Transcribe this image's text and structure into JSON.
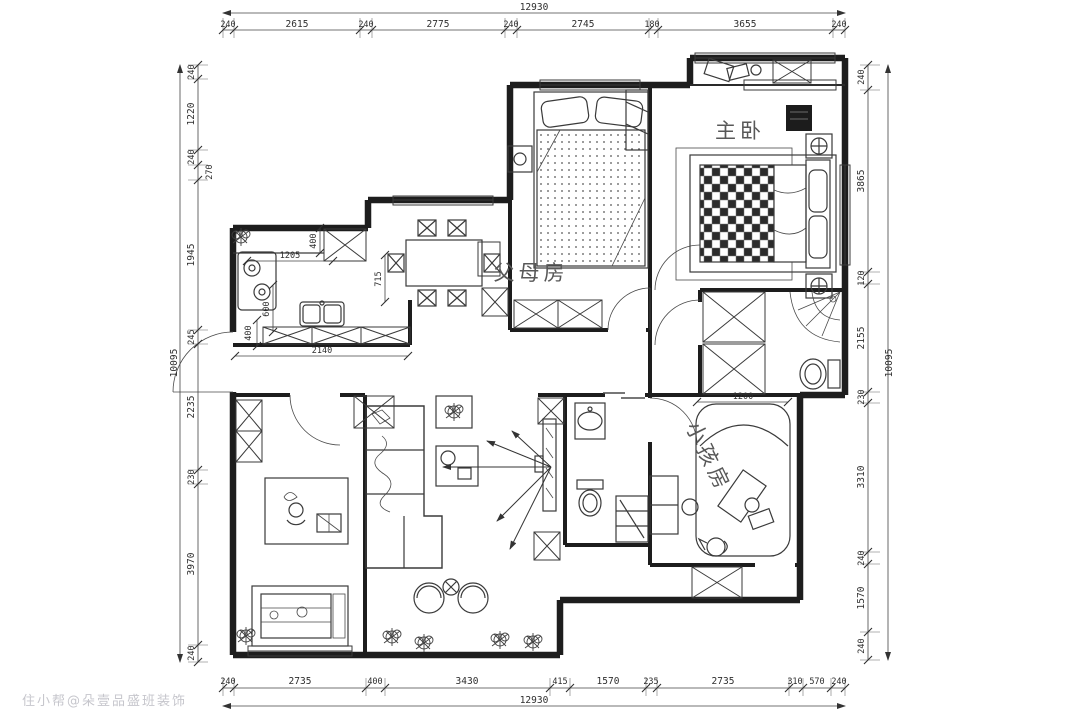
{
  "watermark": "住小帮@朵壹品盛班装饰",
  "rooms": {
    "master": "主卧",
    "parents": "父母房",
    "kids": "小孩房"
  },
  "dims": {
    "top": {
      "total": "12930",
      "segments": [
        "240",
        "2615",
        "240",
        "2775",
        "240",
        "2745",
        "180",
        "3655",
        "240"
      ]
    },
    "bottom": {
      "total": "12930",
      "segments": [
        "240",
        "2735",
        "400",
        "3430",
        "415",
        "1570",
        "235",
        "2735",
        "310",
        "570",
        "240"
      ]
    },
    "left": {
      "total": "10095",
      "segments": [
        "240",
        "1220",
        "240",
        "270",
        "1945",
        "245",
        "2235",
        "230",
        "3970",
        "240"
      ]
    },
    "right": {
      "total": "10095",
      "segments": [
        "240",
        "3865",
        "120",
        "2155",
        "230",
        "3310",
        "240",
        "1570",
        "240"
      ]
    },
    "interior": {
      "kitchen_depth": "400",
      "kitchen_run": "1205",
      "dining_offset": "715",
      "counter_depth": "600",
      "counter_run": "2140",
      "door_width": "400",
      "kids_bed_width": "1200"
    }
  },
  "colors": {
    "line": "#1d1d1d",
    "background": "#ffffff",
    "watermark": "#c6c6cc"
  }
}
